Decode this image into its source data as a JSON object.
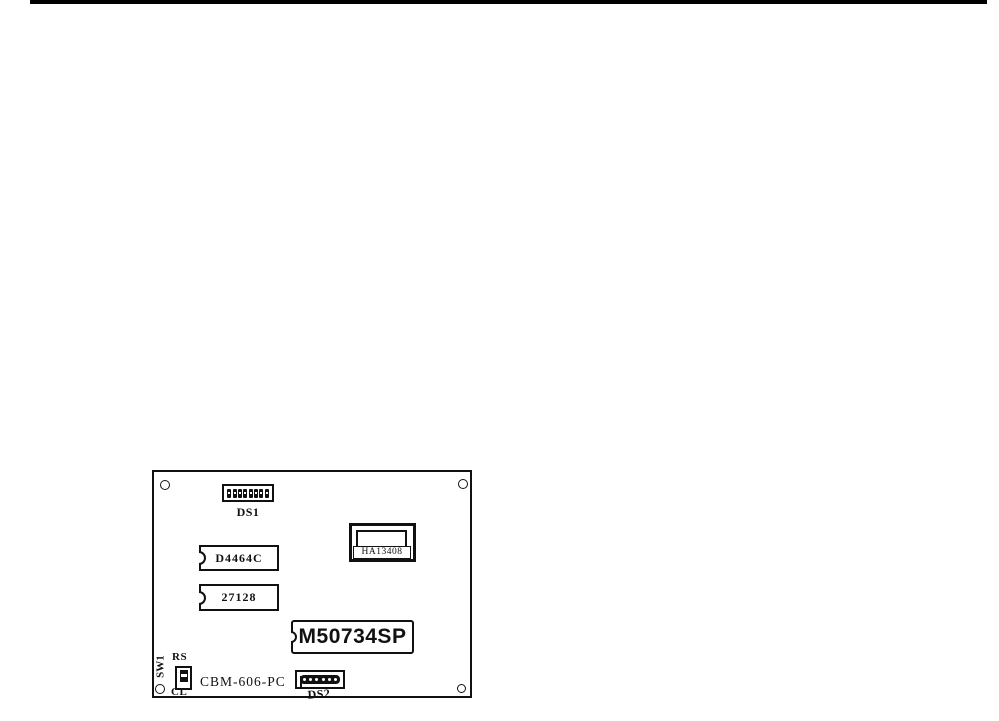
{
  "page": {
    "background": "#ffffff",
    "top_rule_color": "#000000",
    "ink_color": "#111111"
  },
  "figure": {
    "board_label": "CBM-606-PC",
    "components": {
      "ds1": {
        "label": "DS1",
        "type": "dip-switch",
        "positions": 8
      },
      "ds2": {
        "label": "DS2",
        "type": "dip-switch",
        "positions": 6
      },
      "d4464c": {
        "label": "D4464C",
        "type": "ic-chip"
      },
      "eprom_27128": {
        "label": "27128",
        "type": "ic-chip"
      },
      "m50734sp": {
        "label": "M50734SP",
        "type": "ic-chip"
      },
      "ha13408": {
        "label": "HA13408",
        "type": "power-ic"
      },
      "sw1": {
        "label": "SW1",
        "reset_label": "RS",
        "clear_label": "CL",
        "type": "slide-switch"
      }
    }
  }
}
